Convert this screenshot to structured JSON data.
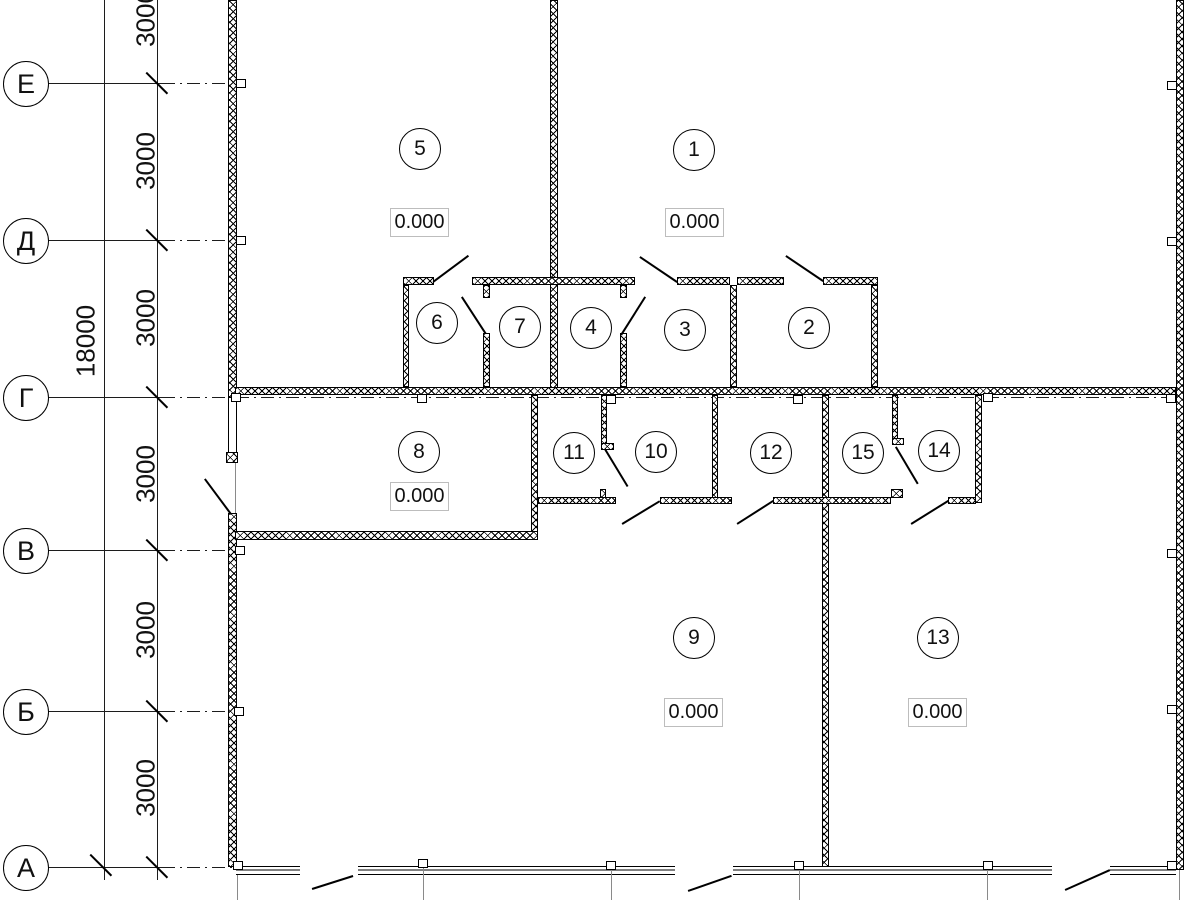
{
  "drawing": {
    "kind": "architectural floor plan, ground level",
    "elevation_value": "0.000"
  },
  "axes": {
    "rows": [
      {
        "label": "Е"
      },
      {
        "label": "Д"
      },
      {
        "label": "Г"
      },
      {
        "label": "В"
      },
      {
        "label": "Б"
      },
      {
        "label": "А"
      }
    ],
    "segment_dims": [
      "3000",
      "3000",
      "3000",
      "3000",
      "3000",
      "3000"
    ],
    "total_dim": "18000"
  },
  "rooms": [
    {
      "number": "1"
    },
    {
      "number": "2"
    },
    {
      "number": "3"
    },
    {
      "number": "4"
    },
    {
      "number": "5"
    },
    {
      "number": "6"
    },
    {
      "number": "7"
    },
    {
      "number": "8"
    },
    {
      "number": "9"
    },
    {
      "number": "10"
    },
    {
      "number": "11"
    },
    {
      "number": "12"
    },
    {
      "number": "13"
    },
    {
      "number": "14"
    },
    {
      "number": "15"
    }
  ],
  "elevations": [
    {
      "room": "5",
      "value": "0.000"
    },
    {
      "room": "1",
      "value": "0.000"
    },
    {
      "room": "8",
      "value": "0.000"
    },
    {
      "room": "9",
      "value": "0.000"
    },
    {
      "room": "13",
      "value": "0.000"
    }
  ],
  "colors": {
    "line": "#000000",
    "background": "#ffffff",
    "elevation_box_border": "#bdbdbd",
    "extension_line": "#8a8a8a"
  }
}
